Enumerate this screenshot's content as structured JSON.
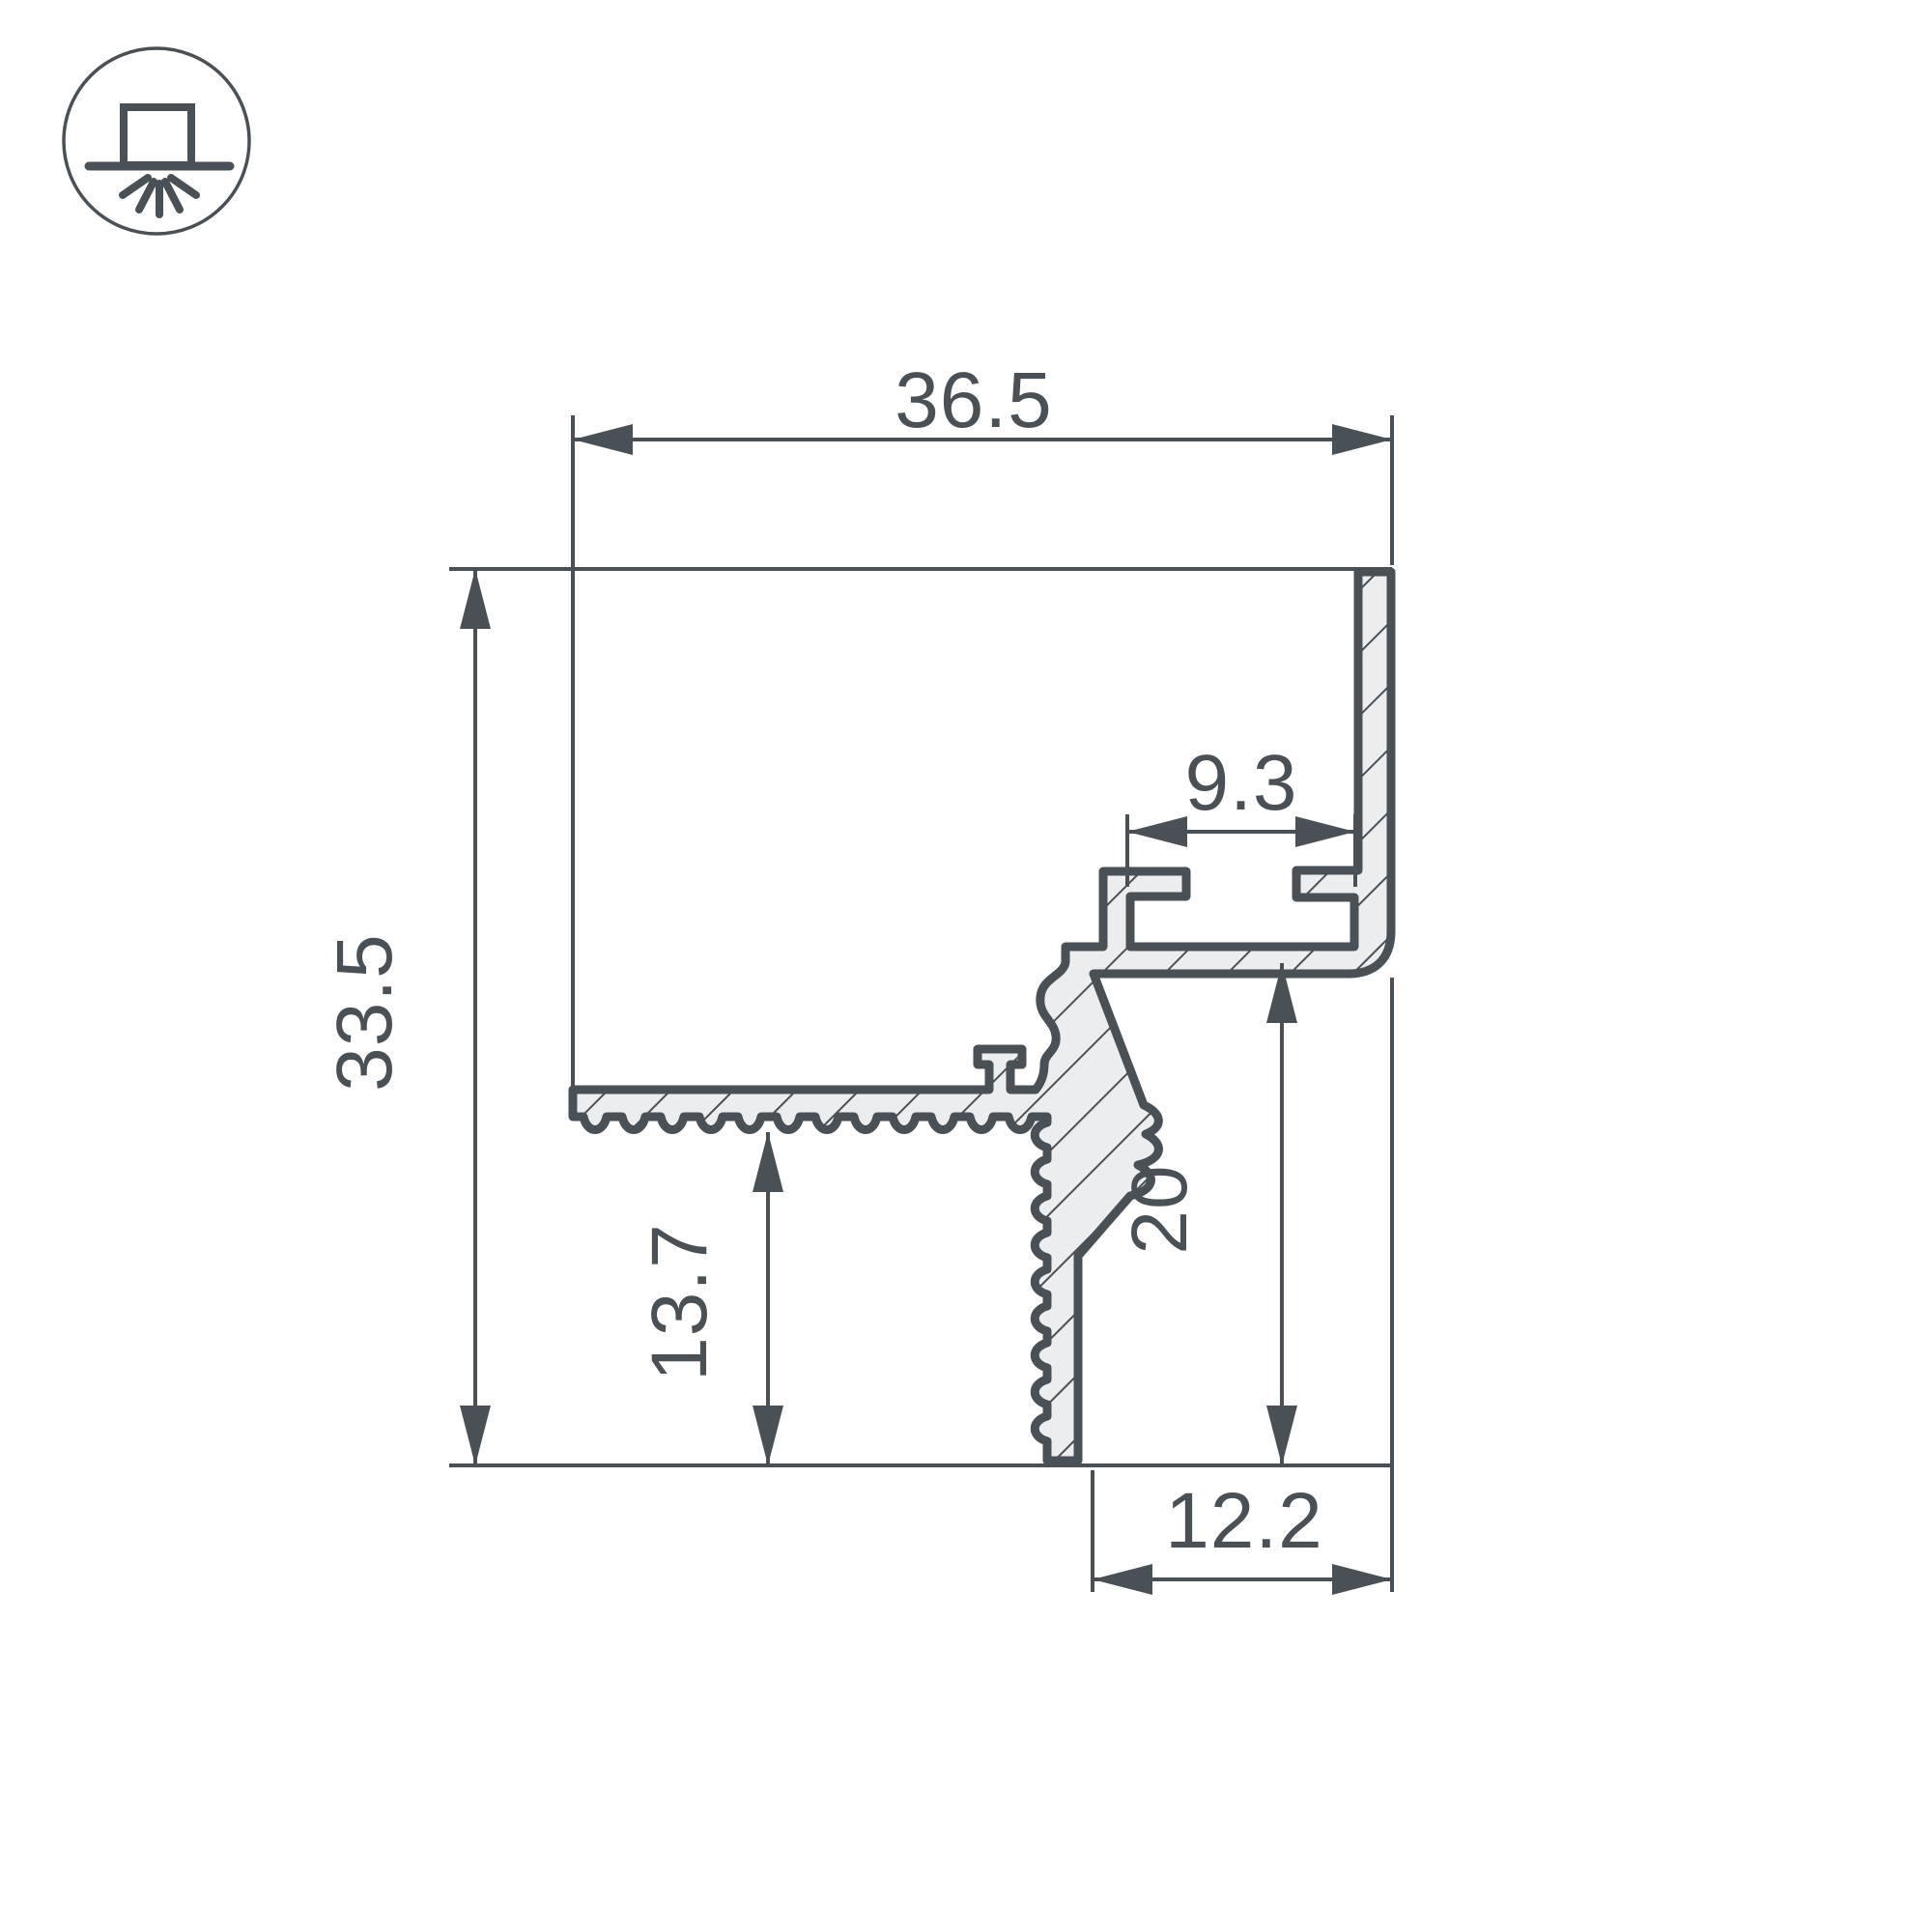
{
  "drawing": {
    "type": "technical-cross-section",
    "subject": "aluminum-led-profile-cross-section",
    "colors": {
      "line": "#4a5156",
      "metal_fill": "#ecedee",
      "background": "#ffffff"
    },
    "icon": {
      "name": "recessed-ceiling-light-icon",
      "description": "circle with surface-mounted luminaire shining downward"
    },
    "dimensions": {
      "top_width": "36.5",
      "overall_height": "33.5",
      "slot_width": "9.3",
      "flange_height": "13.7",
      "right_height": "20",
      "bottom_width": "12.2"
    }
  }
}
